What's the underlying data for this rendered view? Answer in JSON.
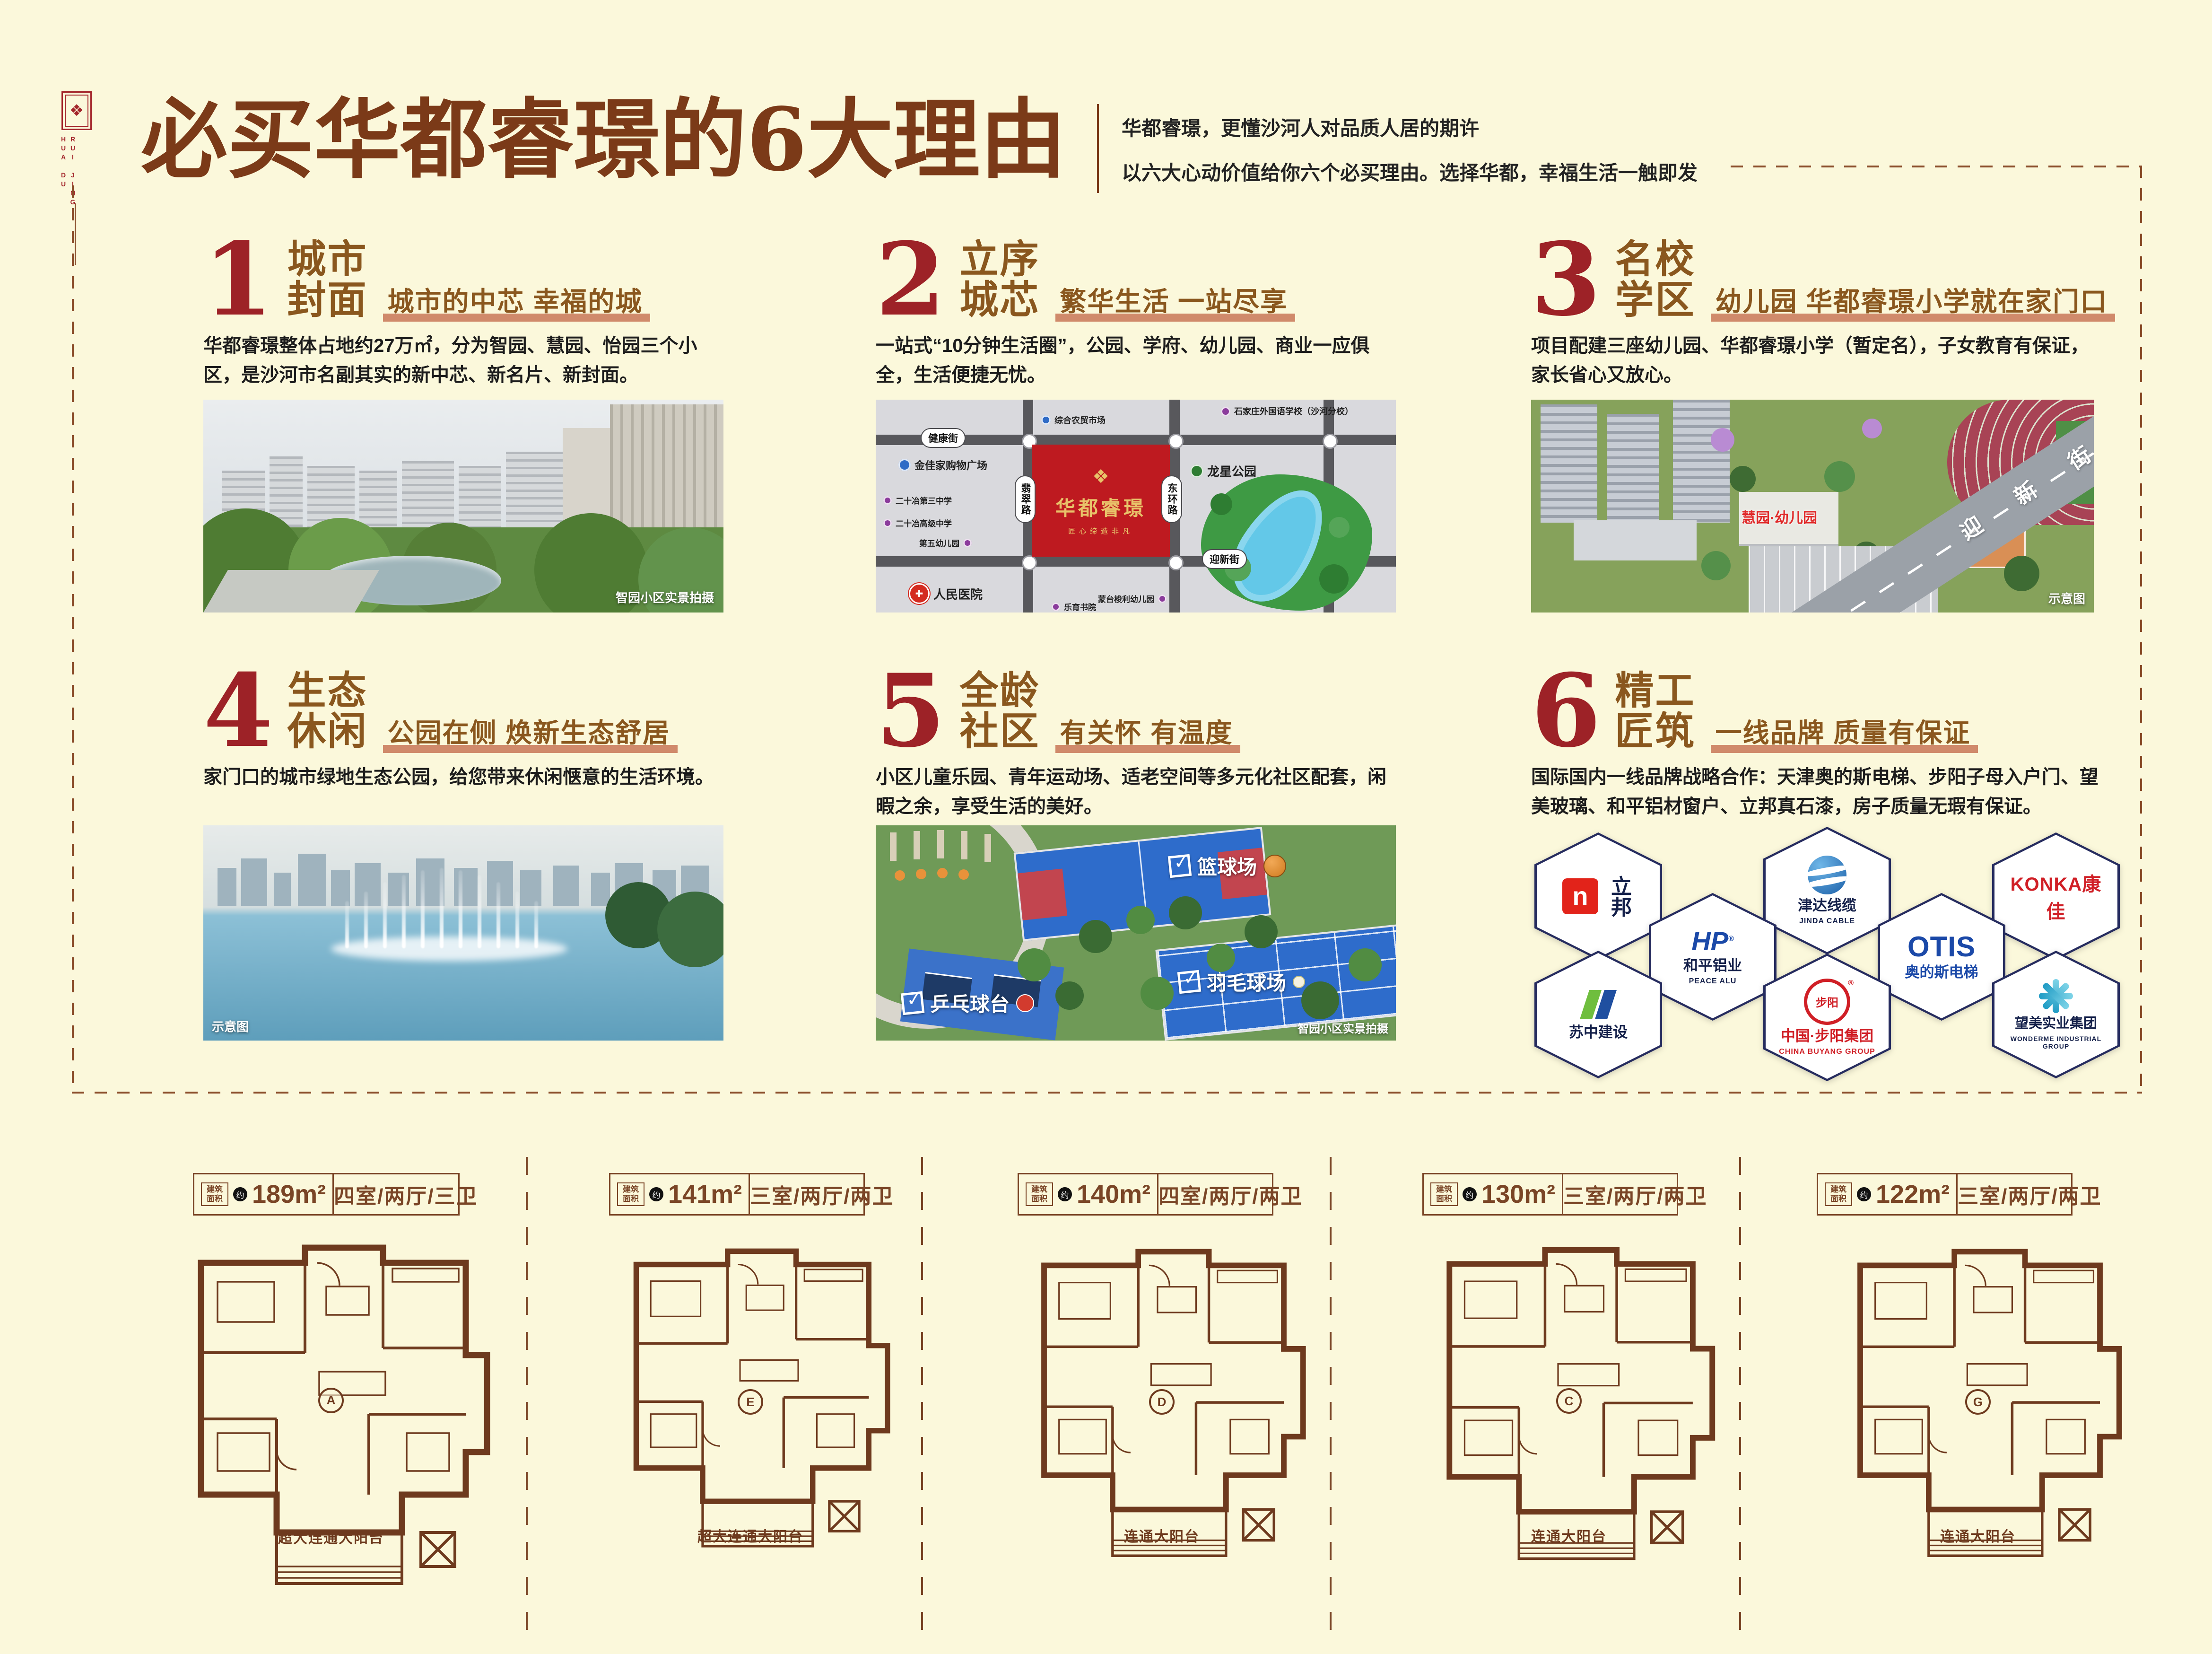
{
  "icons": {
    "check": "✓",
    "reg": "®",
    "cross": "✚",
    "ornament": "❖"
  },
  "header": {
    "logo_text_top": "HUA DU",
    "logo_text_bottom": "RUI JING",
    "title": "必买华都睿璟的6大理由",
    "subtitle_line1": "华都睿璟，更懂沙河人对品质人居的期许",
    "subtitle_line2": "以六大心动价值给你六个必买理由。选择华都，幸福生活一触即发"
  },
  "sections": [
    {
      "number": "1",
      "title1": "城市",
      "title2": "封面",
      "tagline": "城市的中芯 幸福的城",
      "body": "华都睿璟整体占地约27万㎡，分为智园、慧园、怡园三个小区，是沙河市名副其实的新中芯、新名片、新封面。"
    },
    {
      "number": "2",
      "title1": "立序",
      "title2": "城芯",
      "tagline": "繁华生活 一站尽享",
      "body": "一站式“10分钟生活圈”，公园、学府、幼儿园、商业一应俱全，生活便捷无忧。"
    },
    {
      "number": "3",
      "title1": "名校",
      "title2": "学区",
      "tagline": "幼儿园 华都睿璟小学就在家门口",
      "body": "项目配建三座幼儿园、华都睿璟小学（暂定名），子女教育有保证，家长省心又放心。"
    },
    {
      "number": "4",
      "title1": "生态",
      "title2": "休闲",
      "tagline": "公园在侧 焕新生态舒居",
      "body": "家门口的城市绿地生态公园，给您带来休闲惬意的生活环境。"
    },
    {
      "number": "5",
      "title1": "全龄",
      "title2": "社区",
      "tagline": "有关怀 有温度",
      "body": "小区儿童乐园、青年运动场、适老空间等多元化社区配套，闲暇之余，享受生活的美好。"
    },
    {
      "number": "6",
      "title1": "精工",
      "title2": "匠筑",
      "tagline": "一线品牌 质量有保证",
      "body": "国际国内一线品牌战略合作：天津奥的斯电梯、步阳子母入户门、望美玻璃、和平铝材窗户、立邦真石漆，房子质量无瑕有保证。"
    }
  ],
  "community_photo": {
    "caption": "智园小区实景拍摄"
  },
  "map": {
    "project_name": "华都睿璟",
    "project_slogan": "匠心缔造非凡",
    "streets": {
      "north": "健康街",
      "south": "迎新街",
      "west": "翡翠路",
      "east": "东环路"
    },
    "park": "龙星公园",
    "pois": [
      {
        "name": "综合农贸市场"
      },
      {
        "name": "石家庄外国语学校（沙河分校）"
      },
      {
        "name": "金佳家购物广场"
      },
      {
        "name": "二十冶第三中学"
      },
      {
        "name": "二十冶高级中学"
      },
      {
        "name": "第五幼儿园"
      },
      {
        "name": "人民医院"
      },
      {
        "name": "蒙台梭利幼儿园"
      },
      {
        "name": "乐育书院"
      }
    ]
  },
  "school_image": {
    "building_label": "慧园·幼儿园",
    "road_label": "迎新街",
    "caption": "示意图"
  },
  "park_image": {
    "caption": "示意图"
  },
  "sports_image": {
    "tag_basketball": "篮球场",
    "tag_badminton": "羽毛球场",
    "tag_pingpong": "乒乓球台",
    "caption": "智园小区实景拍摄"
  },
  "brands": [
    {
      "mark": "n",
      "cn": "立邦",
      "en": ""
    },
    {
      "mark": "HP",
      "cn": "和平铝业",
      "en": "PEACE ALU"
    },
    {
      "cn": "津达线缆",
      "en": "JINDA CABLE"
    },
    {
      "cn": "奥的斯电梯",
      "en": "OTIS"
    },
    {
      "cn": "KONKA康佳",
      "en": ""
    },
    {
      "cn": "苏中建设",
      "en": ""
    },
    {
      "mark": "步阳",
      "cn": "中国·步阳集团",
      "en": "CHINA BUYANG GROUP"
    },
    {
      "cn": "望美实业集团",
      "en": "WONDERME INDUSTRIAL GROUP"
    }
  ],
  "floor_plans": [
    {
      "area_prefix": "建筑面积",
      "approx": "约",
      "area": "189m²",
      "rooms": "四室/两厅/三卫",
      "balcony": "超大连通大阳台",
      "unit": "A"
    },
    {
      "area_prefix": "建筑面积",
      "approx": "约",
      "area": "141m²",
      "rooms": "三室/两厅/两卫",
      "balcony": "超大连通大阳台",
      "unit": "E"
    },
    {
      "area_prefix": "建筑面积",
      "approx": "约",
      "area": "140m²",
      "rooms": "四室/两厅/两卫",
      "balcony": "连通大阳台",
      "unit": "D"
    },
    {
      "area_prefix": "建筑面积",
      "approx": "约",
      "area": "130m²",
      "rooms": "三室/两厅/两卫",
      "balcony": "连通大阳台",
      "unit": "C"
    },
    {
      "area_prefix": "建筑面积",
      "approx": "约",
      "area": "122m²",
      "rooms": "三室/两厅/两卫",
      "balcony": "连通大阳台",
      "unit": "G"
    }
  ]
}
